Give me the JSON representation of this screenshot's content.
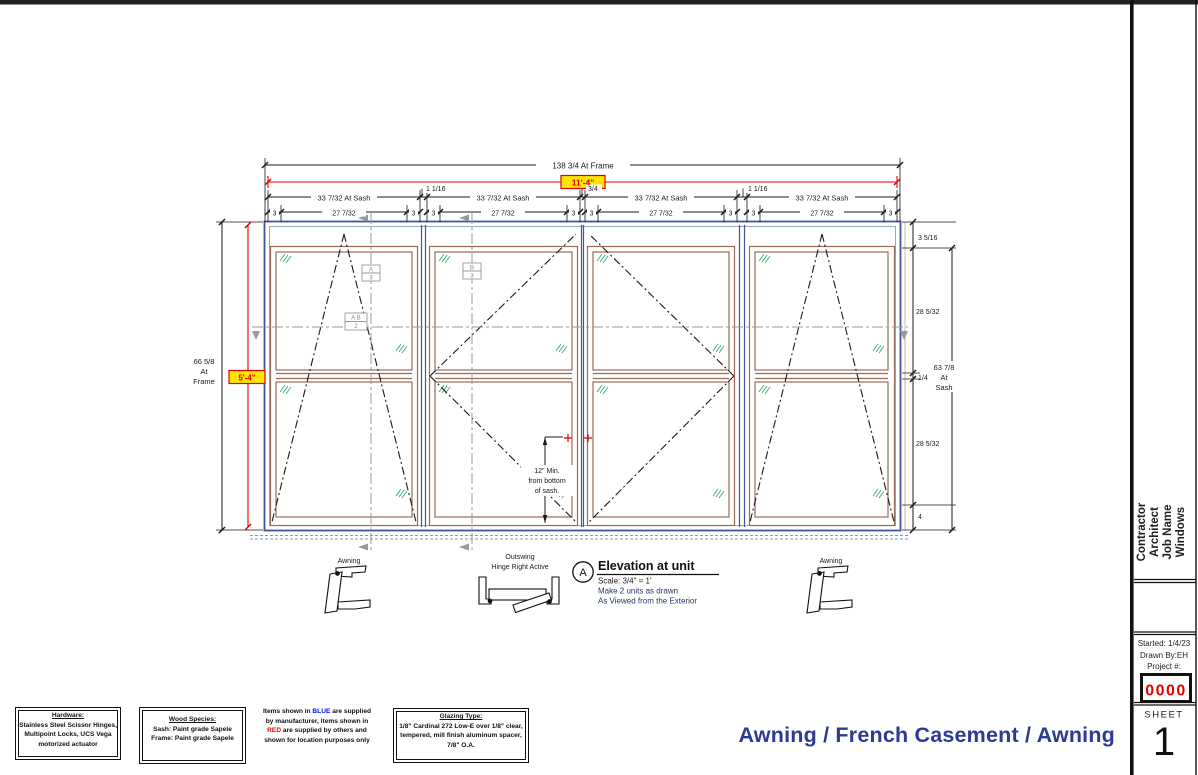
{
  "drawing_title": "Awning / French Casement / Awning",
  "dims": {
    "frame_width": "138 3/4 At Frame",
    "rough_width": "11'-4\"",
    "sash_width": "33 7/32 At Sash",
    "mullion_a": "1 1/16",
    "mullion_b": "3/4",
    "stile": "3",
    "glass_width": "27 7/32",
    "frame_h1": "66 5/8",
    "frame_h2": "At",
    "frame_h3": "Frame",
    "rough_height": "5'-4\"",
    "head": "3 5/16",
    "glass_h_upper": "28 5/32",
    "rail": "1/4",
    "sash_h1": "63 7/8",
    "sash_h2": "At",
    "sash_h3": "Sash",
    "glass_h_lower": "28 5/32",
    "sill": "4",
    "min1": "12\" Min.",
    "min2": "from bottom",
    "min3": "of sash."
  },
  "markers": {
    "a_top": "A",
    "a_bot": "3",
    "b_top": "B",
    "b_bot": "3",
    "ab_top": "A B",
    "ab_bot": "2"
  },
  "symbols": {
    "awning_left": "Awning",
    "outswing_1": "Outswing",
    "outswing_2": "Hinge Right Active",
    "awning_right": "Awning"
  },
  "elevation_note": {
    "marker": "A",
    "title": "Elevation at unit",
    "scale": "Scale: 3/4\" = 1'",
    "line2": "Make 2 units as drawn",
    "line3": "As Viewed from the Exterior"
  },
  "notes": {
    "hardware": {
      "title": "Hardware:",
      "l1": "Stainless Steel Scissor Hinges,",
      "l2": "Multipoint Locks, UCS Vega",
      "l3": "motorized actuator"
    },
    "wood": {
      "title": "Wood Species:",
      "l1": "Sash: Paint grade Sapele",
      "l2": "Frame: Paint grade Sapele"
    },
    "supply": {
      "l1a": "Items shown in ",
      "l1b": "BLUE",
      "l1c": " are supplied",
      "l2": "by manufacturer, items shown in",
      "l3a": "RED",
      "l3b": " are supplied by others and",
      "l4": "shown for location purposes only"
    },
    "glazing": {
      "title": "Glazing Type:",
      "l1": "1/8\" Cardinal 272 Low-E over 1/8\" clear,",
      "l2": "tempered, mill finish aluminum spacer,",
      "l3": "7/8\" O.A."
    }
  },
  "title_block": {
    "line1": "Contractor",
    "line2": "Architect",
    "line3": "Job Name",
    "line4": "Windows",
    "started": "Started: 1/4/23",
    "drawn_by": "Drawn By:EH",
    "project_label": "Project #:",
    "project_number": "0000",
    "sheet_label": "SHEET",
    "sheet_number": "1"
  },
  "colors": {
    "frame_blue": "#44549a",
    "frame_light_blue": "#98a5cd",
    "sash_brown": "#9a6a58",
    "glass_green": "#2fae74",
    "dimension_red": "#e00000",
    "highlight_yellow": "#ffe600",
    "section_grey": "#999999",
    "note_navy": "#1f3864",
    "title_navy": "#2b3a94"
  }
}
